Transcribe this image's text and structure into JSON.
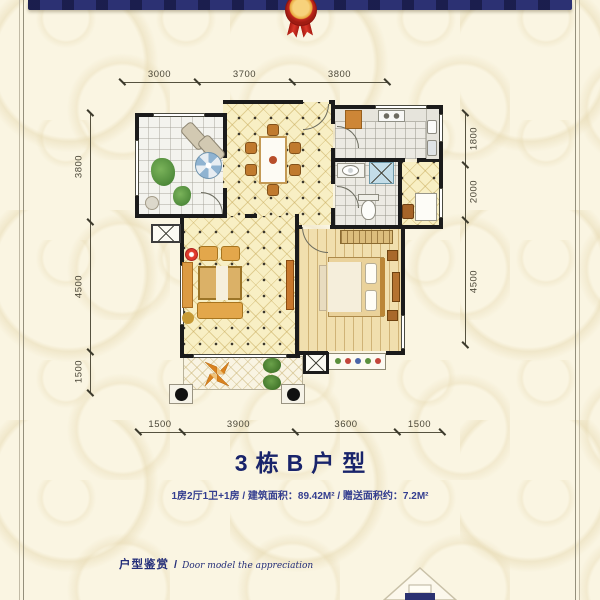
{
  "palette": {
    "background": "#faf5e2",
    "banner_navy": "#2c3173",
    "ribbon_red": "#c3271d",
    "ribbon_gold": "#e9a83d",
    "title_navy": "#19246b",
    "wall_black": "#1b1b1b",
    "floor_yellow": "#f8efc4",
    "floor_wood": "#f1dfae"
  },
  "banner": {
    "icon": "award-rosette-ribbon"
  },
  "plan": {
    "dims_top": [
      "3000",
      "3700",
      "3800"
    ],
    "dims_left": [
      "3800",
      "4500",
      "1500"
    ],
    "dims_right": [
      "1800",
      "2000",
      "4500"
    ],
    "dims_bottom": [
      "1500",
      "3900",
      "3600",
      "1500"
    ],
    "icons": [
      "dining-table",
      "sofa-set",
      "tv-cabinet",
      "bed",
      "wardrobe",
      "nightstand",
      "stove",
      "kitchen-counter",
      "bathroom-sink",
      "shower",
      "toilet",
      "umbrella-table",
      "lounge-chair",
      "potted-plant",
      "compass-rose-motif",
      "column",
      "ac-platform",
      "flower-box"
    ]
  },
  "title": "3栋B户型",
  "subtitle": "1房2厅1卫+1房 / 建筑面积：89.42M² / 赠送面积约：7.2M²",
  "footer": {
    "zh": "户型鉴赏",
    "sep": "/",
    "en": "Door model the appreciation"
  },
  "bottom_motif": {
    "icon": "house-outline"
  }
}
